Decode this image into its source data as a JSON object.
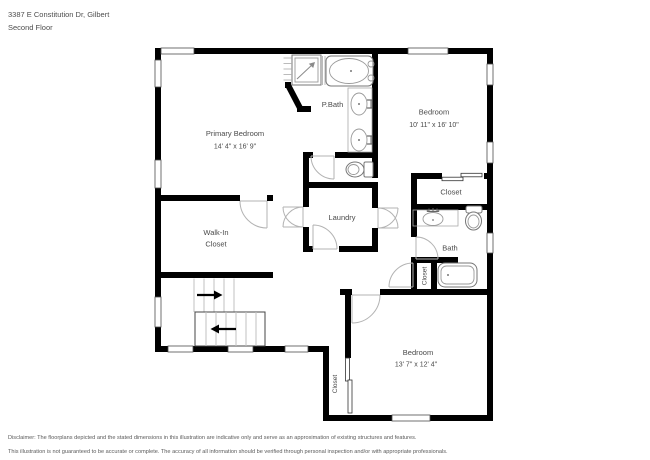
{
  "header": {
    "address_line": "3387 E Constitution Dr, Gilbert",
    "floor_line": "Second Floor"
  },
  "floorplan": {
    "rooms": {
      "primary_bedroom": {
        "label": "Primary Bedroom",
        "dimensions": "14' 4\" x 16' 9\""
      },
      "p_bath": {
        "label": "P.Bath"
      },
      "bedroom_upper": {
        "label": "Bedroom",
        "dimensions": "10' 11\" x 16' 10\""
      },
      "closet_upper": {
        "label": "Closet"
      },
      "bath": {
        "label": "Bath"
      },
      "bath_closet": {
        "label": "Closet"
      },
      "laundry": {
        "label": "Laundry"
      },
      "walk_in_closet": {
        "line1": "Walk-In",
        "line2": "Closet"
      },
      "bedroom_lower": {
        "label": "Bedroom",
        "dimensions": "13' 7\" x 12' 4\""
      },
      "bedroom_lower_closet": {
        "label": "Closet"
      }
    }
  },
  "disclaimer": {
    "line1": "Disclaimer: The floorplans depicted and the stated dimensions in this illustration are indicative only and serve as an approximation of existing structures and features.",
    "line2": "This illustration is not guaranteed to be accurate or complete. The accuracy of all information should be verified through personal inspection and/or with appropriate professionals."
  }
}
